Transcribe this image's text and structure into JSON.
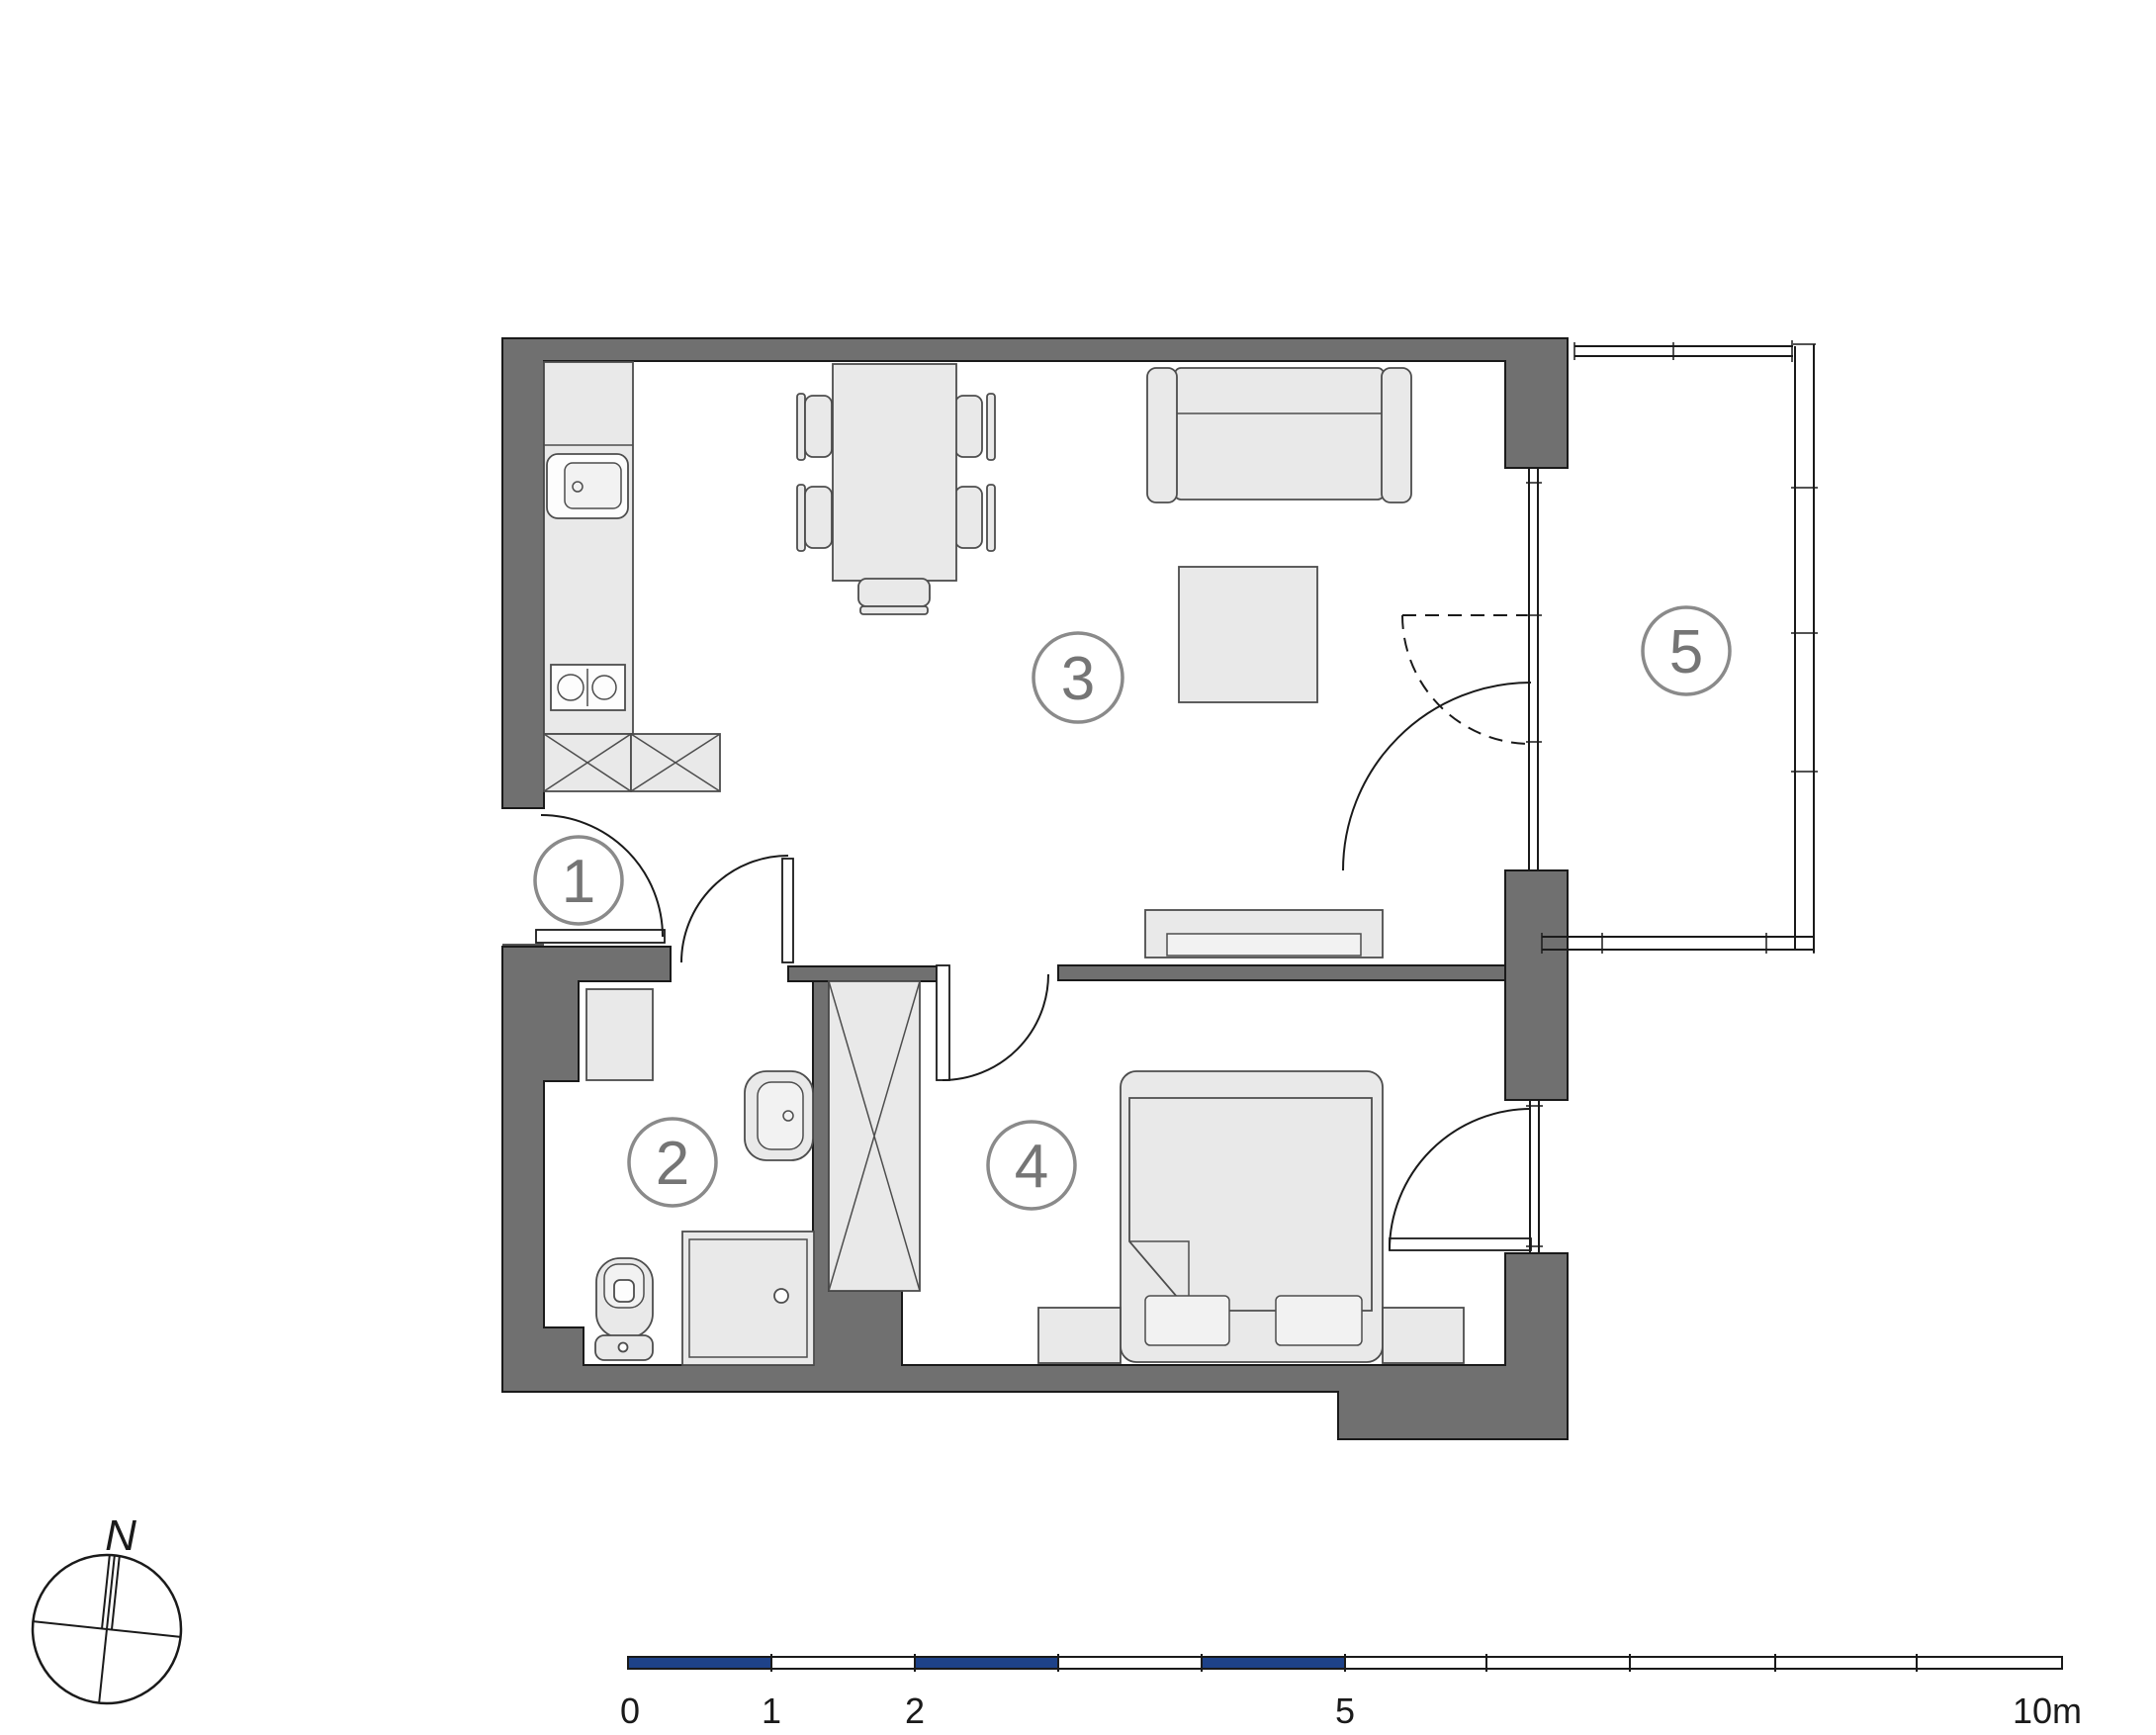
{
  "plan": {
    "rooms": [
      {
        "number": "1"
      },
      {
        "number": "2"
      },
      {
        "number": "3"
      },
      {
        "number": "4"
      },
      {
        "number": "5"
      }
    ]
  },
  "compass": {
    "label": "N"
  },
  "scale_bar": {
    "labels": [
      "0",
      "1",
      "2",
      "5",
      "10m"
    ]
  },
  "colors": {
    "background": "#ffffff",
    "wall": "#707070",
    "furniture": "#e9e9e9",
    "outline": "#1a1a1a",
    "furniture_outline": "#4d4d4d",
    "room_label_ring": "#8a8a8a",
    "room_label_text": "#757575",
    "scalebar_blue": "#1e4289"
  }
}
